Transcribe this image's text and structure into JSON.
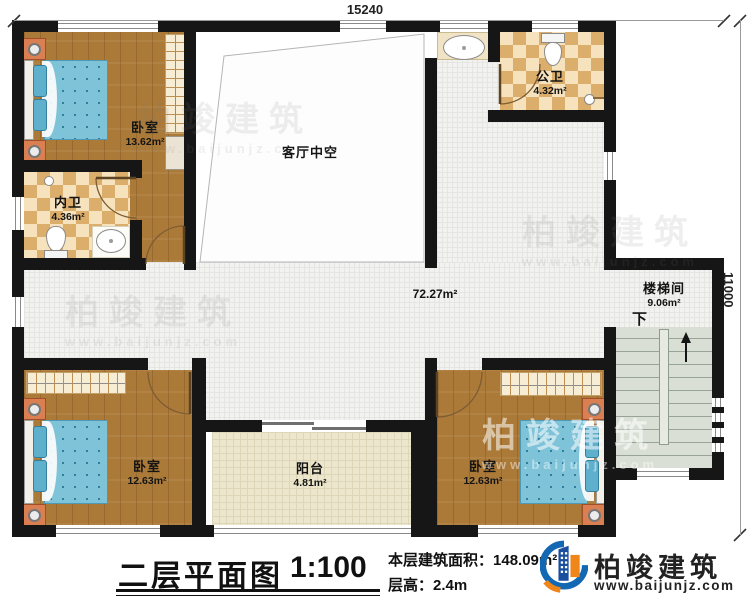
{
  "plan": {
    "dimensions": {
      "width": "15240",
      "height": "11000"
    },
    "rooms": [
      {
        "name": "卧室",
        "area": "13.62m²"
      },
      {
        "name": "内卫",
        "area": "4.36m²"
      },
      {
        "name": "公卫",
        "area": "4.32m²"
      },
      {
        "name": "客厅中空",
        "area": ""
      },
      {
        "name": "",
        "area": "72.27m²"
      },
      {
        "name": "楼梯间",
        "area": "9.06m²",
        "direction": "下"
      },
      {
        "name": "卧室",
        "area": "12.63m²"
      },
      {
        "name": "阳台",
        "area": "4.81m²"
      },
      {
        "name": "卧室",
        "area": "12.63m²"
      }
    ]
  },
  "titleblock": {
    "title": "二层平面图",
    "scale": "1:100",
    "area_label": "本层建筑面积：",
    "area_value": "148.09m²",
    "floor_height_label": "层高：",
    "floor_height_value": "2.4m"
  },
  "branding": {
    "company": "柏竣建筑",
    "website": "www.baijunjz.com"
  },
  "watermark": {
    "company": "柏竣建筑",
    "website": "www.baijunjz.com"
  },
  "colors": {
    "wall": "#161616",
    "wood_floor": "#ab7a38",
    "bed_blue": "#7fc3d9",
    "bath_tile": "#dcae6c",
    "stairs": "#d9dfd5",
    "logo_blue": "#1a4e9e",
    "logo_orange": "#f08519"
  }
}
